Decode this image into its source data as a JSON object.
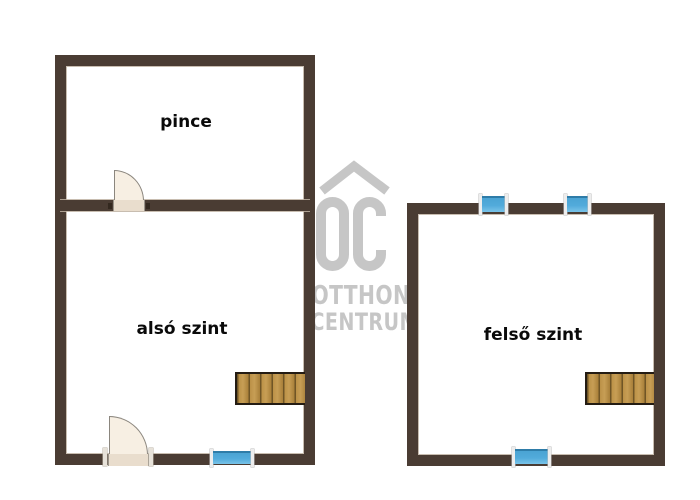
{
  "canvas": {
    "width": 700,
    "height": 500,
    "background": "#ffffff"
  },
  "watermark": {
    "monogram": "OC",
    "line1": "OTTHON",
    "line2": "CENTRUM",
    "color": "#c6c6c6"
  },
  "rooms": {
    "basement": {
      "label": "pince"
    },
    "lower": {
      "label": "alsó szint"
    },
    "upper": {
      "label": "felső szint"
    }
  },
  "fixtures": {
    "doors": 2,
    "windows": 4,
    "staircases": 2
  },
  "colors": {
    "wall": "#4a3c33",
    "wall_highlight": "#c0b4a4",
    "window_glass": "#4aa3d3",
    "window_frame": "#ededed",
    "stair_wood": "#b68c42",
    "stair_stripe": "#6f5526",
    "door_leaf": "#f7efe3",
    "door_outline": "#8b867e",
    "watermark": "#c6c6c6",
    "label_text": "#0a0a0a"
  }
}
